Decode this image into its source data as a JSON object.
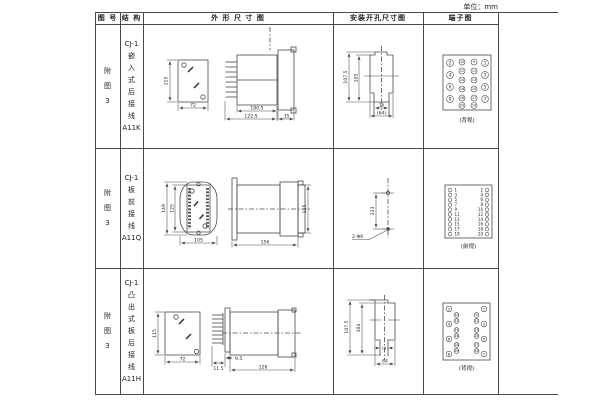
{
  "unit_label": "单位：mm",
  "header": {
    "figure": "图 号",
    "structure": "结 构",
    "outline": "外 形 尺 寸 图",
    "mounting": "安装开孔尺寸图",
    "terminal": "端子图"
  },
  "rows": [
    {
      "figure_lines": [
        "附",
        "图",
        "3"
      ],
      "structure_lines": [
        "CJ-1",
        "嵌",
        "入",
        "式",
        "后",
        "接",
        "线",
        "A11K"
      ],
      "outline": {
        "height": "115",
        "width": "72",
        "depth": "100.5",
        "depth_total": "122.5",
        "panel": "35"
      },
      "mounting": {
        "h1": "107.5",
        "h2": "105",
        "w1": "16",
        "w2": "(64)"
      },
      "terminal": {
        "caption": "(背视)",
        "dots": [
          {
            "x": 27,
            "y": 39,
            "r": 3.4,
            "n": "2",
            "fs": 4
          },
          {
            "x": 27,
            "y": 51,
            "r": 3.4,
            "n": "4",
            "fs": 4
          },
          {
            "x": 27,
            "y": 63,
            "r": 3.4,
            "n": "6",
            "fs": 4
          },
          {
            "x": 27,
            "y": 75,
            "r": 3.4,
            "n": "8",
            "fs": 4
          },
          {
            "x": 62,
            "y": 39,
            "r": 3.4,
            "n": "1",
            "fs": 4
          },
          {
            "x": 62,
            "y": 51,
            "r": 3.4,
            "n": "3",
            "fs": 4
          },
          {
            "x": 62,
            "y": 63,
            "r": 3.4,
            "n": "5",
            "fs": 4
          },
          {
            "x": 62,
            "y": 75,
            "r": 3.4,
            "n": "7",
            "fs": 4
          },
          {
            "x": 39,
            "y": 38,
            "r": 3,
            "n": "10",
            "fs": 3.4
          },
          {
            "x": 51,
            "y": 38,
            "r": 3,
            "n": "9",
            "fs": 3.4
          },
          {
            "x": 39,
            "y": 47,
            "r": 3,
            "n": "12",
            "fs": 3.4
          },
          {
            "x": 51,
            "y": 47,
            "r": 3,
            "n": "11",
            "fs": 3.4
          },
          {
            "x": 39,
            "y": 56,
            "r": 3,
            "n": "14",
            "fs": 3.4
          },
          {
            "x": 51,
            "y": 56,
            "r": 3,
            "n": "13",
            "fs": 3.4
          },
          {
            "x": 39,
            "y": 65,
            "r": 3,
            "n": "16",
            "fs": 3.4
          },
          {
            "x": 51,
            "y": 65,
            "r": 3,
            "n": "15",
            "fs": 3.4
          },
          {
            "x": 39,
            "y": 74,
            "r": 3,
            "n": "18",
            "fs": 3.4
          },
          {
            "x": 51,
            "y": 74,
            "r": 3,
            "n": "17",
            "fs": 3.4
          },
          {
            "x": 39,
            "y": 81.5,
            "r": 3,
            "n": "20",
            "fs": 3.4
          },
          {
            "x": 51,
            "y": 81.5,
            "r": 3,
            "n": "19",
            "fs": 3.4
          }
        ]
      }
    },
    {
      "figure_lines": [
        "附",
        "图",
        "3"
      ],
      "structure_lines": [
        "CJ-1",
        "板",
        "前",
        "接",
        "线",
        "A11Q"
      ],
      "outline": {
        "height": "149",
        "inner_height": "125",
        "width": "105",
        "depth": "156",
        "side_height": "115"
      },
      "mounting": {
        "span": "133",
        "holes": "2-Φ6"
      },
      "terminal": {
        "caption": "(前视)",
        "dots": [
          {
            "x": 27,
            "y": 42,
            "r": 1.8,
            "n": "1",
            "fs": 4,
            "lx": 31.5,
            "ta": "start"
          },
          {
            "x": 27,
            "y": 46.9,
            "r": 1.8,
            "n": "3",
            "fs": 4,
            "lx": 31.5,
            "ta": "start"
          },
          {
            "x": 27,
            "y": 51.8,
            "r": 1.8,
            "n": "5",
            "fs": 4,
            "lx": 31.5,
            "ta": "start"
          },
          {
            "x": 27,
            "y": 56.7,
            "r": 1.8,
            "n": "7",
            "fs": 4,
            "lx": 31.5,
            "ta": "start"
          },
          {
            "x": 27,
            "y": 61.6,
            "r": 1.8,
            "n": "9",
            "fs": 4,
            "lx": 31.5,
            "ta": "start"
          },
          {
            "x": 27,
            "y": 66.5,
            "r": 1.8,
            "n": "11",
            "fs": 4,
            "lx": 31.5,
            "ta": "start"
          },
          {
            "x": 27,
            "y": 71.4,
            "r": 1.8,
            "n": "13",
            "fs": 4,
            "lx": 31.5,
            "ta": "start"
          },
          {
            "x": 27,
            "y": 76.3,
            "r": 1.8,
            "n": "15",
            "fs": 4,
            "lx": 31.5,
            "ta": "start"
          },
          {
            "x": 27,
            "y": 81.2,
            "r": 1.8,
            "n": "17",
            "fs": 4,
            "lx": 31.5,
            "ta": "start"
          },
          {
            "x": 27,
            "y": 86.1,
            "r": 1.8,
            "n": "19",
            "fs": 4,
            "lx": 31.5,
            "ta": "start"
          },
          {
            "x": 64,
            "y": 42,
            "r": 1.8,
            "n": "2",
            "fs": 4,
            "lx": 60,
            "ta": "end"
          },
          {
            "x": 64,
            "y": 46.9,
            "r": 1.8,
            "n": "4",
            "fs": 4,
            "lx": 60,
            "ta": "end"
          },
          {
            "x": 64,
            "y": 51.8,
            "r": 1.8,
            "n": "6",
            "fs": 4,
            "lx": 60,
            "ta": "end"
          },
          {
            "x": 64,
            "y": 56.7,
            "r": 1.8,
            "n": "8",
            "fs": 4,
            "lx": 60,
            "ta": "end"
          },
          {
            "x": 64,
            "y": 61.6,
            "r": 1.8,
            "n": "10",
            "fs": 4,
            "lx": 60,
            "ta": "end"
          },
          {
            "x": 64,
            "y": 66.5,
            "r": 1.8,
            "n": "12",
            "fs": 4,
            "lx": 60,
            "ta": "end"
          },
          {
            "x": 64,
            "y": 71.4,
            "r": 1.8,
            "n": "14",
            "fs": 4,
            "lx": 60,
            "ta": "end"
          },
          {
            "x": 64,
            "y": 76.3,
            "r": 1.8,
            "n": "16",
            "fs": 4,
            "lx": 60,
            "ta": "end"
          },
          {
            "x": 64,
            "y": 81.2,
            "r": 1.8,
            "n": "18",
            "fs": 4,
            "lx": 60,
            "ta": "end"
          },
          {
            "x": 64,
            "y": 86.1,
            "r": 1.8,
            "n": "20",
            "fs": 4,
            "lx": 60,
            "ta": "end"
          }
        ]
      }
    },
    {
      "figure_lines": [
        "附",
        "图",
        "3"
      ],
      "structure_lines": [
        "CJ-1",
        "凸",
        "出",
        "式",
        "板",
        "后",
        "接",
        "线",
        "A11H"
      ],
      "outline": {
        "height": "115",
        "width": "72",
        "off1": "11.5",
        "off2": "9.5",
        "depth": "126"
      },
      "mounting": {
        "h1": "107.5",
        "h2": "104",
        "w1": "16",
        "w2": "64"
      },
      "terminal": {
        "caption": "(背视)",
        "dots": [
          {
            "x": 26,
            "y": 41,
            "r": 2.8,
            "n": "2",
            "fs": 3.8
          },
          {
            "x": 26,
            "y": 56,
            "r": 2.8,
            "n": "4",
            "fs": 3.8
          },
          {
            "x": 26,
            "y": 71,
            "r": 2.8,
            "n": "6",
            "fs": 3.8
          },
          {
            "x": 26,
            "y": 86,
            "r": 2.8,
            "n": "8",
            "fs": 3.8
          },
          {
            "x": 33.5,
            "y": 47,
            "r": 2.4,
            "n": "10",
            "fs": 3.2
          },
          {
            "x": 33.5,
            "y": 53,
            "r": 2.4,
            "n": "12",
            "fs": 3.2
          },
          {
            "x": 33.5,
            "y": 62,
            "r": 2.4,
            "n": "14",
            "fs": 3.2
          },
          {
            "x": 33.5,
            "y": 68,
            "r": 2.4,
            "n": "16",
            "fs": 3.2
          },
          {
            "x": 33.5,
            "y": 77,
            "r": 2.4,
            "n": "18",
            "fs": 3.2
          },
          {
            "x": 33.5,
            "y": 83,
            "r": 2.4,
            "n": "20",
            "fs": 3.2
          },
          {
            "x": 53.5,
            "y": 47,
            "r": 2.4,
            "n": "9",
            "fs": 3.2
          },
          {
            "x": 53.5,
            "y": 53,
            "r": 2.4,
            "n": "11",
            "fs": 3.2
          },
          {
            "x": 53.5,
            "y": 62,
            "r": 2.4,
            "n": "13",
            "fs": 3.2
          },
          {
            "x": 53.5,
            "y": 68,
            "r": 2.4,
            "n": "15",
            "fs": 3.2
          },
          {
            "x": 53.5,
            "y": 77,
            "r": 2.4,
            "n": "17",
            "fs": 3.2
          },
          {
            "x": 53.5,
            "y": 83,
            "r": 2.4,
            "n": "19",
            "fs": 3.2
          },
          {
            "x": 61,
            "y": 41,
            "r": 2.8,
            "n": "1",
            "fs": 3.8
          },
          {
            "x": 61,
            "y": 56,
            "r": 2.8,
            "n": "3",
            "fs": 3.8
          },
          {
            "x": 61,
            "y": 71,
            "r": 2.8,
            "n": "5",
            "fs": 3.8
          },
          {
            "x": 61,
            "y": 86,
            "r": 2.8,
            "n": "7",
            "fs": 3.8
          }
        ]
      }
    }
  ]
}
